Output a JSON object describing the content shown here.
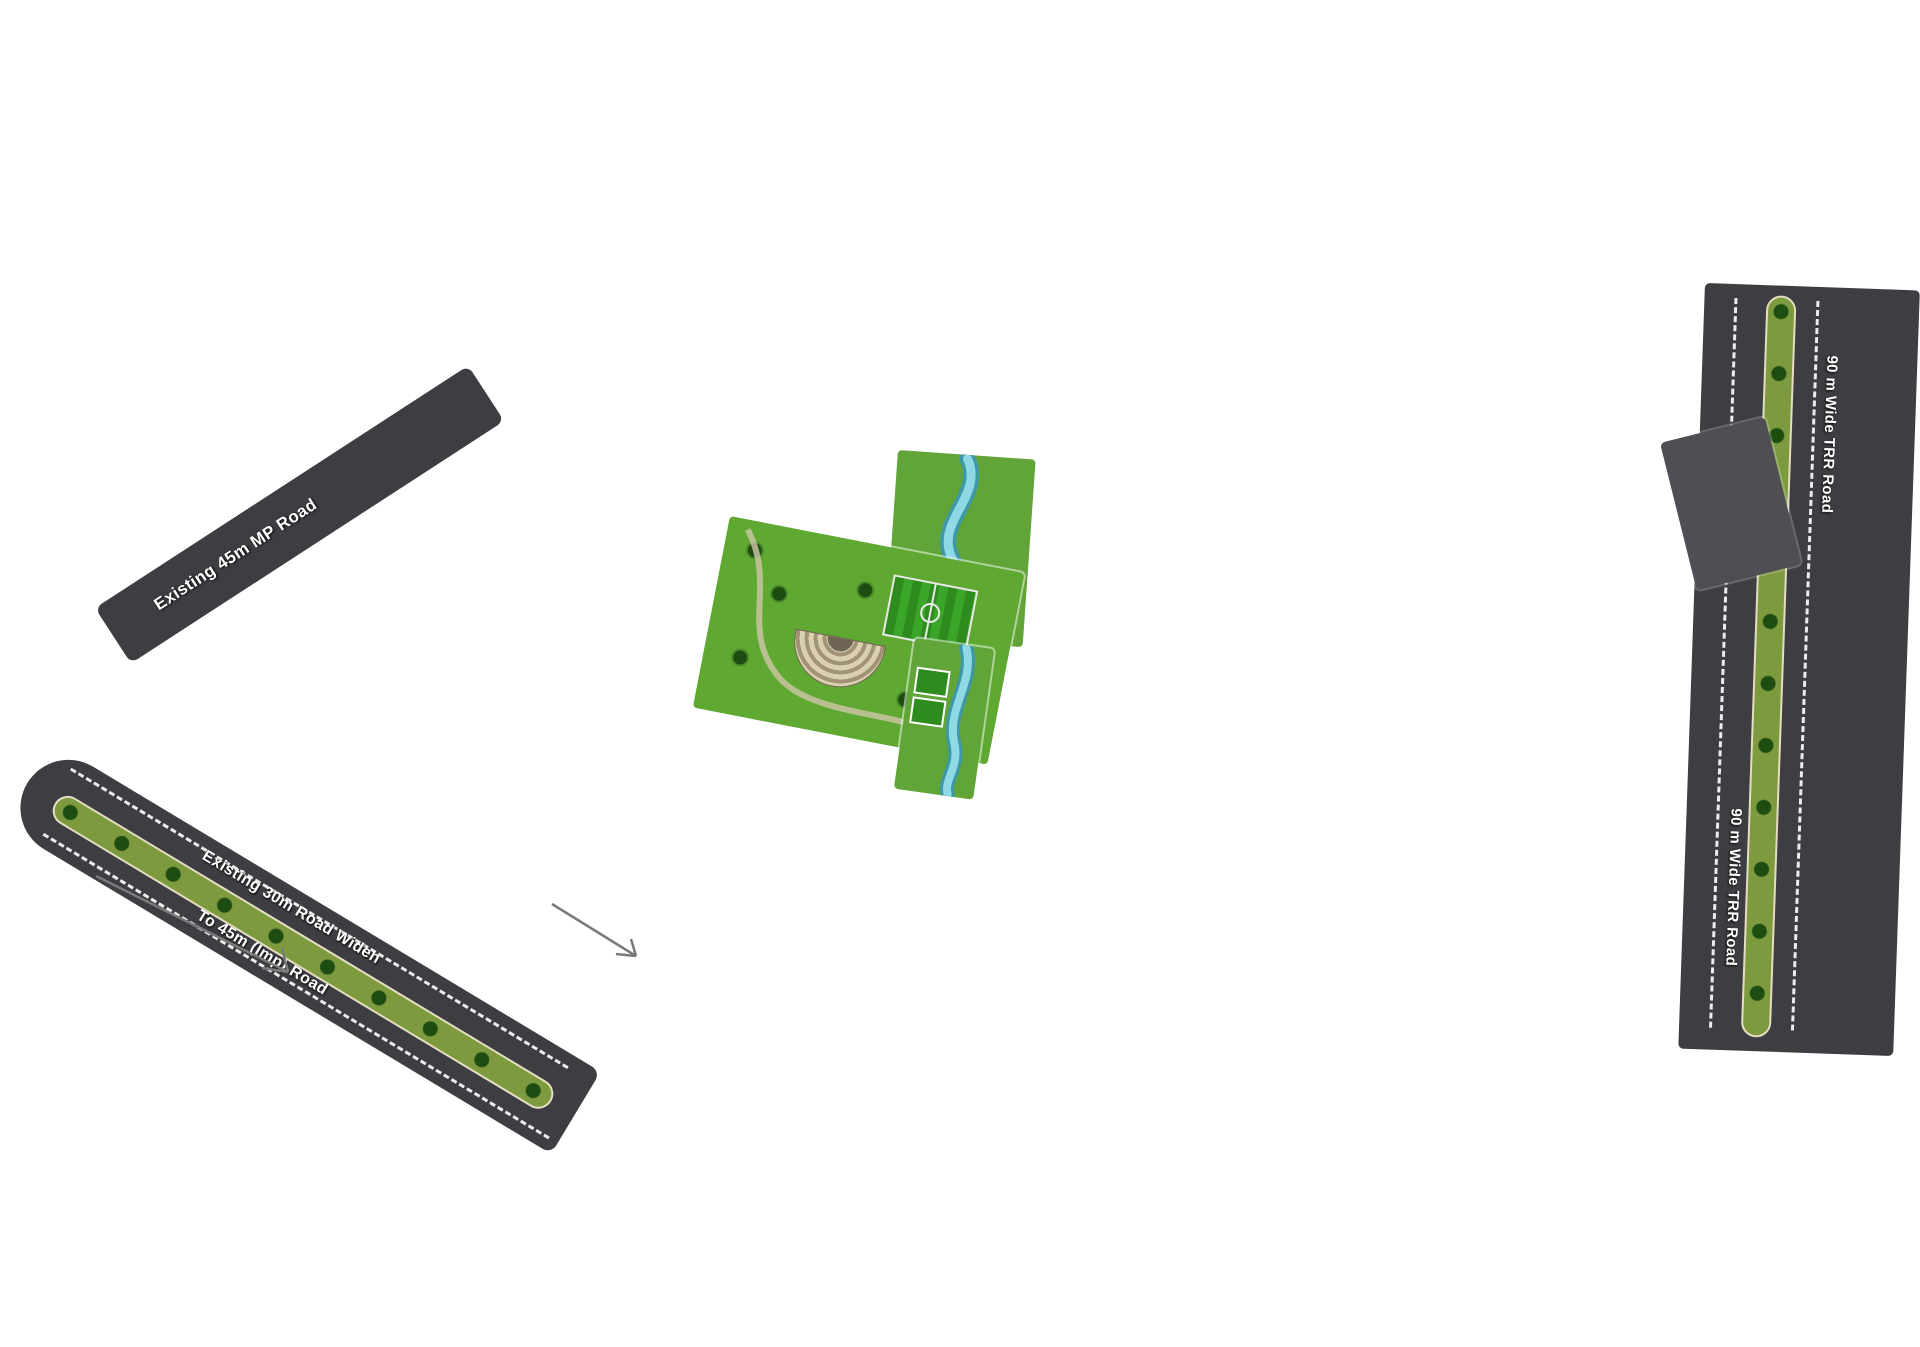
{
  "map": {
    "road_labels": {
      "existing_9m": "Existing 9m Road",
      "wide_9m": "9m Wide Road",
      "wide_12m": "12m Wide Road",
      "mp_12m": "12m MP Road",
      "existing_12m": "Existing 12m Road",
      "existing_45m_mp": "Existing 45m MP Road",
      "existing_30m_line1": "Existing 30m Road Widen",
      "existing_30m_line2": "To 45m (Imp) Road",
      "trr_90m": "90 m Wide TRR Road",
      "from_hoskote": "From Hoskote",
      "to_malur": "To Malur"
    },
    "park_labels": {
      "park4": "Park-4"
    },
    "plot_colors": {
      "olive": "#9CAD55",
      "light_olive": "#B7C173",
      "teal": "#12808A",
      "dark_green": "#1E8A2E",
      "medium_green": "#46AD68",
      "road": "#3E3D42",
      "park_green": "#61A437"
    },
    "plot_color_groups": {
      "dark_green": [
        "13",
        "14",
        "39",
        "40",
        "65",
        "66",
        "119",
        "120",
        "153",
        "154",
        "190",
        "191",
        "220",
        "221",
        "235",
        "250",
        "265",
        "298"
      ],
      "teal": [
        "215",
        "216",
        "217",
        "218",
        "219",
        "222",
        "223",
        "224",
        "225",
        "226",
        "227",
        "237",
        "238",
        "239",
        "240",
        "241",
        "242",
        "245",
        "246",
        "247",
        "248",
        "249",
        "253",
        "254",
        "255",
        "256",
        "257",
        "260",
        "261",
        "262",
        "263",
        "264",
        "268",
        "269",
        "270",
        "271",
        "272",
        "282",
        "283",
        "284",
        "285",
        "286",
        "287",
        "288",
        "289",
        "290",
        "297"
      ],
      "medium_green": [
        "230",
        "231",
        "232",
        "233",
        "234"
      ],
      "light_olive": [
        "83",
        "84",
        "85",
        "86",
        "87",
        "88",
        "89",
        "90",
        "91",
        "92",
        "93",
        "94",
        "95",
        "96",
        "97",
        "98",
        "99",
        "100",
        "101",
        "102"
      ]
    },
    "blocks": {
      "col_a": {
        "dir": "v",
        "rows": [
          [
            "79"
          ],
          [
            "80"
          ],
          [
            "81"
          ],
          [
            "82"
          ],
          [
            "83"
          ],
          [
            "84"
          ],
          [
            "85"
          ],
          [
            "86"
          ]
        ]
      },
      "col_b": {
        "dir": "v",
        "rows": [
          [
            "78",
            "53"
          ],
          [
            "77",
            "54"
          ],
          [
            "76",
            "55"
          ],
          [
            "75",
            "56"
          ],
          [
            "74",
            "57"
          ],
          [
            "73",
            "58"
          ],
          [
            "72",
            "59"
          ],
          [
            "71",
            "60"
          ],
          [
            "70",
            "61"
          ],
          [
            "69",
            "62"
          ],
          [
            "68",
            "63"
          ],
          [
            "67",
            "64"
          ],
          [
            "66",
            "65"
          ]
        ]
      },
      "col_c": {
        "dir": "v",
        "rows": [
          [
            "52",
            "27"
          ],
          [
            "51",
            "28"
          ],
          [
            "50",
            "29"
          ],
          [
            "49",
            "30"
          ],
          [
            "48",
            "31"
          ],
          [
            "47",
            "32"
          ],
          [
            "46",
            "33"
          ],
          [
            "45",
            "34"
          ],
          [
            "44",
            "35"
          ],
          [
            "43",
            "36"
          ],
          [
            "42",
            "37"
          ],
          [
            "41",
            "38"
          ],
          [
            "40",
            "39"
          ]
        ]
      },
      "col_d": {
        "dir": "v",
        "rows": [
          [
            "26",
            "1"
          ],
          [
            "25",
            "2"
          ],
          [
            "24",
            "3"
          ],
          [
            "23",
            "4"
          ],
          [
            "22",
            "5"
          ],
          [
            "21",
            "6"
          ],
          [
            "20",
            "7"
          ],
          [
            "19",
            "8"
          ],
          [
            "18",
            "9"
          ],
          [
            "17",
            "10"
          ],
          [
            "16",
            "11"
          ],
          [
            "15",
            "12"
          ],
          [
            "14",
            "13"
          ]
        ]
      },
      "col_e": {
        "dir": "v",
        "rows": [
          [
            "191",
            "190"
          ],
          [
            "192",
            "189"
          ],
          [
            "193",
            "188"
          ],
          [
            "194",
            "187"
          ],
          [
            "195",
            "186"
          ],
          [
            "196",
            "185"
          ],
          [
            "197",
            "184"
          ],
          [
            "198",
            "183"
          ],
          [
            "199",
            "182"
          ],
          [
            "200",
            "181"
          ],
          [
            "201",
            "180"
          ],
          [
            "202",
            "179"
          ],
          [
            "203",
            "178"
          ],
          [
            "204",
            "177"
          ],
          [
            "205",
            "176"
          ],
          [
            "206",
            "175"
          ],
          [
            "207",
            "174"
          ],
          [
            "208",
            "173"
          ],
          [
            "209",
            "172"
          ]
        ]
      },
      "col_f": {
        "dir": "v",
        "rows": [
          [
            "154",
            "153"
          ],
          [
            "155",
            "152"
          ],
          [
            "156",
            "151"
          ],
          [
            "157",
            "150"
          ],
          [
            "158",
            "149"
          ],
          [
            "159",
            "148"
          ],
          [
            "160",
            "147"
          ],
          [
            "161",
            "146"
          ],
          [
            "162",
            "145"
          ],
          [
            "163",
            "144"
          ],
          [
            "164",
            "143"
          ],
          [
            "165",
            "142"
          ],
          [
            "166",
            "141"
          ],
          [
            "167",
            "140"
          ],
          [
            "168",
            "139"
          ],
          [
            "169",
            "138"
          ],
          [
            "170",
            "137"
          ],
          [
            "171"
          ]
        ]
      },
      "col_g": {
        "dir": "v",
        "rows": [
          [
            "120",
            "119"
          ],
          [
            "121",
            "118"
          ],
          [
            "122",
            "117"
          ],
          [
            "123",
            "116"
          ],
          [
            "124",
            "115"
          ],
          [
            "125",
            "114"
          ],
          [
            "126",
            "113"
          ],
          [
            "127",
            "112"
          ],
          [
            "128",
            "111"
          ],
          [
            "129",
            "110"
          ],
          [
            "130",
            "109"
          ],
          [
            "131",
            "108"
          ],
          [
            "132",
            "107"
          ],
          [
            "133",
            "106"
          ],
          [
            "134",
            "105"
          ],
          [
            "135",
            "104"
          ],
          [
            "136",
            "103"
          ]
        ]
      },
      "col_h": {
        "dir": "v",
        "rows": [
          [
            "87"
          ],
          [
            "88"
          ],
          [
            "89"
          ],
          [
            "90"
          ],
          [
            "91"
          ],
          [
            "92"
          ],
          [
            "93"
          ],
          [
            "94"
          ],
          [
            "95"
          ],
          [
            "96"
          ],
          [
            "97"
          ],
          [
            "98"
          ],
          [
            "99"
          ],
          [
            "100"
          ],
          [
            "101"
          ],
          [
            "102"
          ]
        ]
      },
      "strip_302": {
        "dir": "h",
        "cols": [
          [
            "317"
          ],
          [
            "316"
          ],
          [
            "315"
          ],
          [
            "314"
          ],
          [
            "313"
          ],
          [
            "312"
          ],
          [
            "311"
          ],
          [
            "310"
          ],
          [
            "309"
          ],
          [
            "308"
          ],
          [
            "307"
          ],
          [
            "306"
          ],
          [
            "305"
          ],
          [
            "304"
          ],
          [
            "302",
            "303"
          ]
        ]
      },
      "b_296": {
        "dir": "v",
        "rows": [
          [
            "301",
            "296"
          ],
          [
            "300",
            "297"
          ],
          [
            "299",
            "298"
          ]
        ]
      },
      "b_295": {
        "dir": "v",
        "rows": [
          [
            "295"
          ],
          [
            "294"
          ],
          [
            "293",
            "292"
          ]
        ]
      },
      "block_1": {
        "dir": "v",
        "rows": [
          [
            "267",
            "266",
            "265"
          ],
          [
            "268",
            "264"
          ],
          [
            "269",
            "263"
          ],
          [
            "270",
            "262"
          ],
          [
            "271",
            "261"
          ],
          [
            "272",
            "260"
          ],
          [
            "273",
            "259"
          ]
        ]
      },
      "block_2": {
        "dir": "v",
        "rows": [
          [
            "252",
            "251",
            "250"
          ],
          [
            "253",
            "249"
          ],
          [
            "254",
            "248"
          ],
          [
            "255",
            "247"
          ],
          [
            "256",
            "246"
          ],
          [
            "257",
            "245"
          ],
          [
            "258",
            "244"
          ]
        ]
      },
      "block_3": {
        "dir": "v",
        "rows": [
          [
            "237",
            "236",
            "235"
          ],
          [
            "238",
            "234"
          ],
          [
            "239",
            "233"
          ],
          [
            "240",
            "232"
          ],
          [
            "241",
            "231"
          ],
          [
            "242",
            "230"
          ],
          [
            "243"
          ]
        ]
      },
      "block_4": {
        "dir": "v",
        "rows": [
          [
            "222",
            "221",
            "220"
          ],
          [
            "223",
            "219"
          ],
          [
            "224",
            "218"
          ],
          [
            "225",
            "217"
          ],
          [
            "226",
            "216"
          ],
          [
            "227",
            "215"
          ],
          [
            "228",
            "214"
          ],
          [
            "229",
            "213"
          ],
          [
            "212"
          ],
          [
            "211"
          ],
          [
            "210"
          ]
        ]
      },
      "row_284": {
        "dir": "h",
        "cols": [
          [
            "291"
          ],
          [
            "290"
          ],
          [
            "289"
          ],
          [
            "288"
          ],
          [
            "287"
          ],
          [
            "286"
          ],
          [
            "285"
          ],
          [
            "284"
          ],
          [
            "283"
          ],
          [
            "282"
          ],
          [
            "281",
            "280"
          ]
        ]
      },
      "col_274": {
        "dir": "v",
        "rows": [
          [
            "279"
          ],
          [
            "278"
          ],
          [
            "277"
          ],
          [
            "276"
          ],
          [
            "275"
          ],
          [
            "274"
          ]
        ]
      },
      "col_l1": {
        "dir": "v",
        "rows": [
          [
            "367"
          ],
          [
            "368"
          ],
          [
            "369"
          ],
          [
            "370"
          ],
          [
            "371"
          ]
        ]
      },
      "col_l2": {
        "dir": "v",
        "rows": [
          [
            "363",
            "362"
          ],
          [
            "364",
            "361"
          ],
          [
            "365",
            "360"
          ],
          [
            "366",
            "359"
          ]
        ]
      },
      "col_l3": {
        "dir": "v",
        "rows": [
          [
            "351",
            "350"
          ],
          [
            "352",
            "349"
          ],
          [
            "353",
            "348"
          ],
          [
            "354",
            "347"
          ],
          [
            "355",
            "346"
          ]
        ]
      },
      "b_372": {
        "dir": "v",
        "rows": [
          [
            "372",
            "373",
            "374",
            "375",
            "376"
          ],
          [
            "377"
          ]
        ]
      },
      "b_356": {
        "dir": "v",
        "rows": [
          [
            "356"
          ],
          [
            "357"
          ],
          [
            "358"
          ]
        ]
      },
      "b_345": {
        "dir": "v",
        "rows": [
          [
            "345"
          ],
          [
            "344"
          ]
        ]
      },
      "row_333": {
        "dir": "h",
        "cols": [
          [
            "343"
          ],
          [
            "342"
          ],
          [
            "341"
          ],
          [
            "340"
          ],
          [
            "339"
          ],
          [
            "338"
          ],
          [
            "337"
          ],
          [
            "336"
          ],
          [
            "335",
            "334"
          ],
          [
            "333"
          ]
        ]
      },
      "row_318": {
        "dir": "h",
        "cols": [
          [
            "332",
            "331"
          ],
          [
            "330"
          ],
          [
            "329"
          ],
          [
            "328"
          ],
          [
            "327"
          ],
          [
            "326"
          ],
          [
            "325"
          ],
          [
            "324"
          ],
          [
            "323"
          ],
          [
            "322"
          ],
          [
            "321",
            "319"
          ],
          [
            "320",
            "318"
          ]
        ]
      }
    }
  }
}
